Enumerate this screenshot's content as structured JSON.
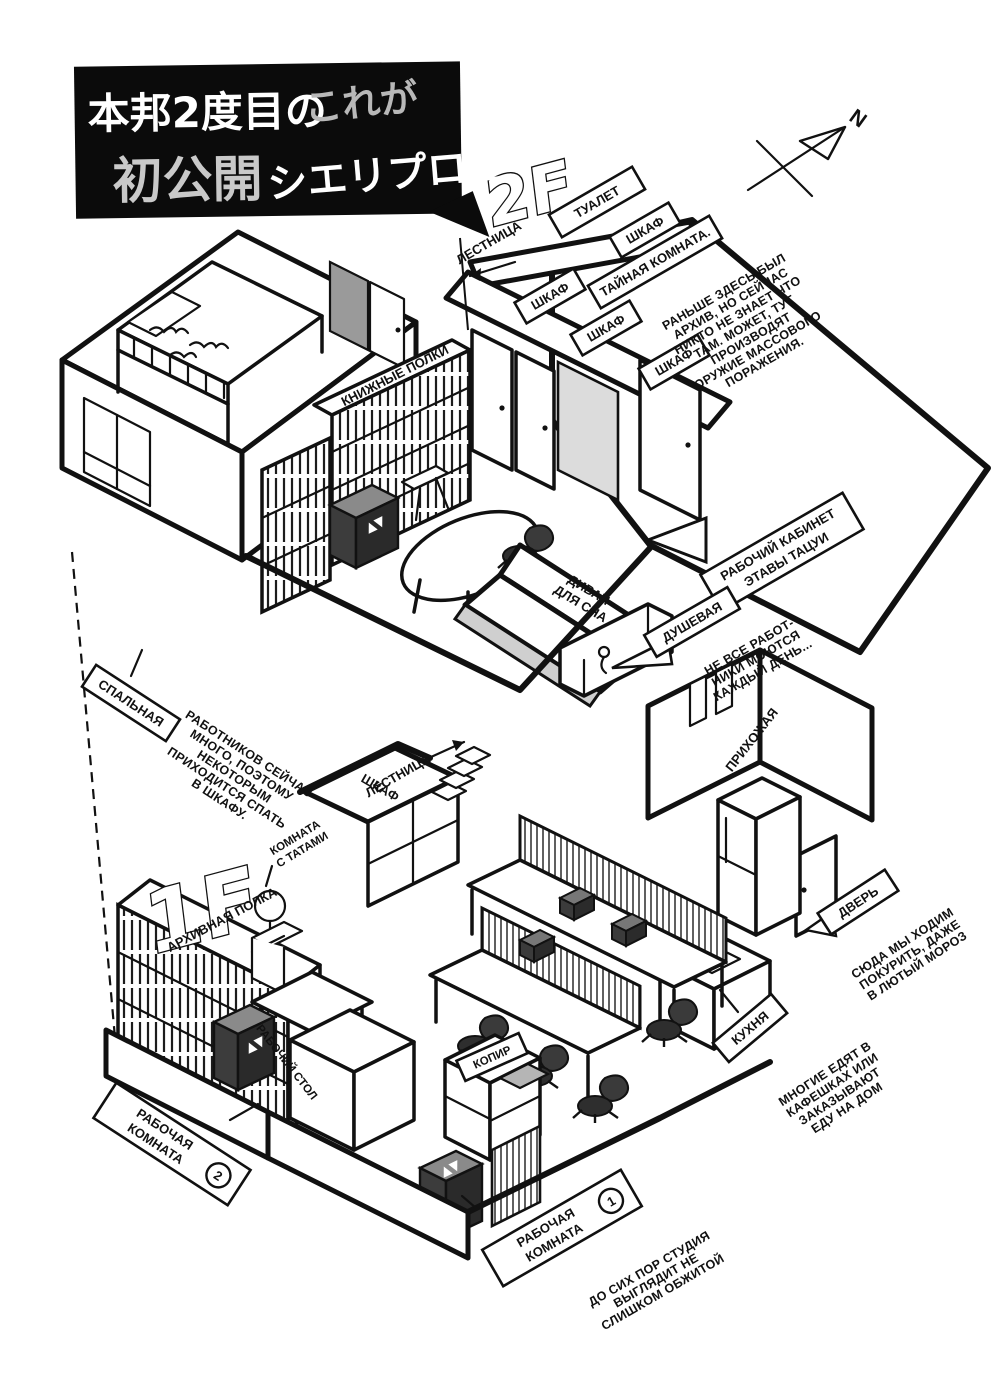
{
  "title_box": {
    "line1_main": "本邦2度目の",
    "line1_sub": "これが",
    "line2_main": "初公開",
    "line2_sub": "シエリプロだ"
  },
  "compass": {
    "north": "N"
  },
  "tv_marks": "▲▼",
  "floor2": {
    "big_label": "2F",
    "stairs": "ЛЕСТНИЦА",
    "toilet": "ТУАЛЕТ",
    "closet": "ШКАФ",
    "bookshelves": "КНИЖНЫЕ ПОЛКИ",
    "secret_room": {
      "title": "ТАЙНАЯ КОМНАТА.",
      "lines": [
        "РАНЬШЕ ЗДЕСЬ БЫЛ",
        "АРХИВ, НО СЕЙЧАС",
        "НИКТО НЕ ЗНАЕТ ЧТО",
        "ТАМ. МОЖЕТ, ТУТ",
        "ПРОИЗВОДЯТ",
        "ОРУЖИЕ МАССОВОГО",
        "ПОРАЖЕНИЯ."
      ]
    },
    "sofa": {
      "line1": "ДИВАН",
      "line2": "ДЛЯ СНА"
    },
    "office": {
      "line1": "РАБОЧИЙ КАБИНЕТ",
      "line2": "ЭТАВЫ ТАЦУИ"
    },
    "shower": {
      "label": "ДУШЕВАЯ",
      "lines": [
        "НЕ ВСЕ РАБОТ-",
        "НИКИ МОЮТСЯ",
        "КАЖДЫЙ ДЕНЬ..."
      ]
    },
    "bedroom": {
      "label": "СПАЛЬНАЯ",
      "lines": [
        "РАБОТНИКОВ СЕЙЧАС",
        "МНОГО, ПОЭТОМУ",
        "НЕКОТОРЫМ",
        "ПРИХОДИТСЯ СПАТЬ",
        "В ШКАФУ."
      ]
    }
  },
  "floor1": {
    "big_label": "1F",
    "stairs": "ЛЕСТНИЦА",
    "closet": "ШКАФ",
    "tatami": {
      "line1": "КОМНАТА",
      "line2": "С ТАТАМИ"
    },
    "archive": "АРХИВНАЯ ПОЛКА",
    "entry": "ПРИХОЖАЯ",
    "door": {
      "label": "ДВЕРЬ",
      "lines": [
        "СЮДА МЫ ХОДИМ",
        "ПОКУРИТЬ, ДАЖЕ",
        "В ЛЮТЫЙ МОРОЗ"
      ]
    },
    "kitchen": {
      "label": "КУХНЯ",
      "lines": [
        "МНОГИЕ ЕДЯТ В",
        "КАФЕШКАХ ИЛИ",
        "ЗАКАЗЫВАЮТ",
        "ЕДУ НА ДОМ"
      ]
    },
    "workroom2": {
      "line1": "РАБОЧАЯ",
      "line2": "КОМНАТА",
      "num": "2"
    },
    "desk": "РАБОЧИЙ СТОЛ",
    "copier": "КОПИР",
    "workroom1": {
      "line1": "РАБОЧАЯ",
      "line2": "КОМНАТА",
      "num": "1",
      "lines": [
        "ДО СИХ ПОР СТУДИЯ",
        "ВЫГЛЯДИТ НЕ",
        "СЛИШКОМ ОБЖИТОЙ"
      ]
    }
  }
}
